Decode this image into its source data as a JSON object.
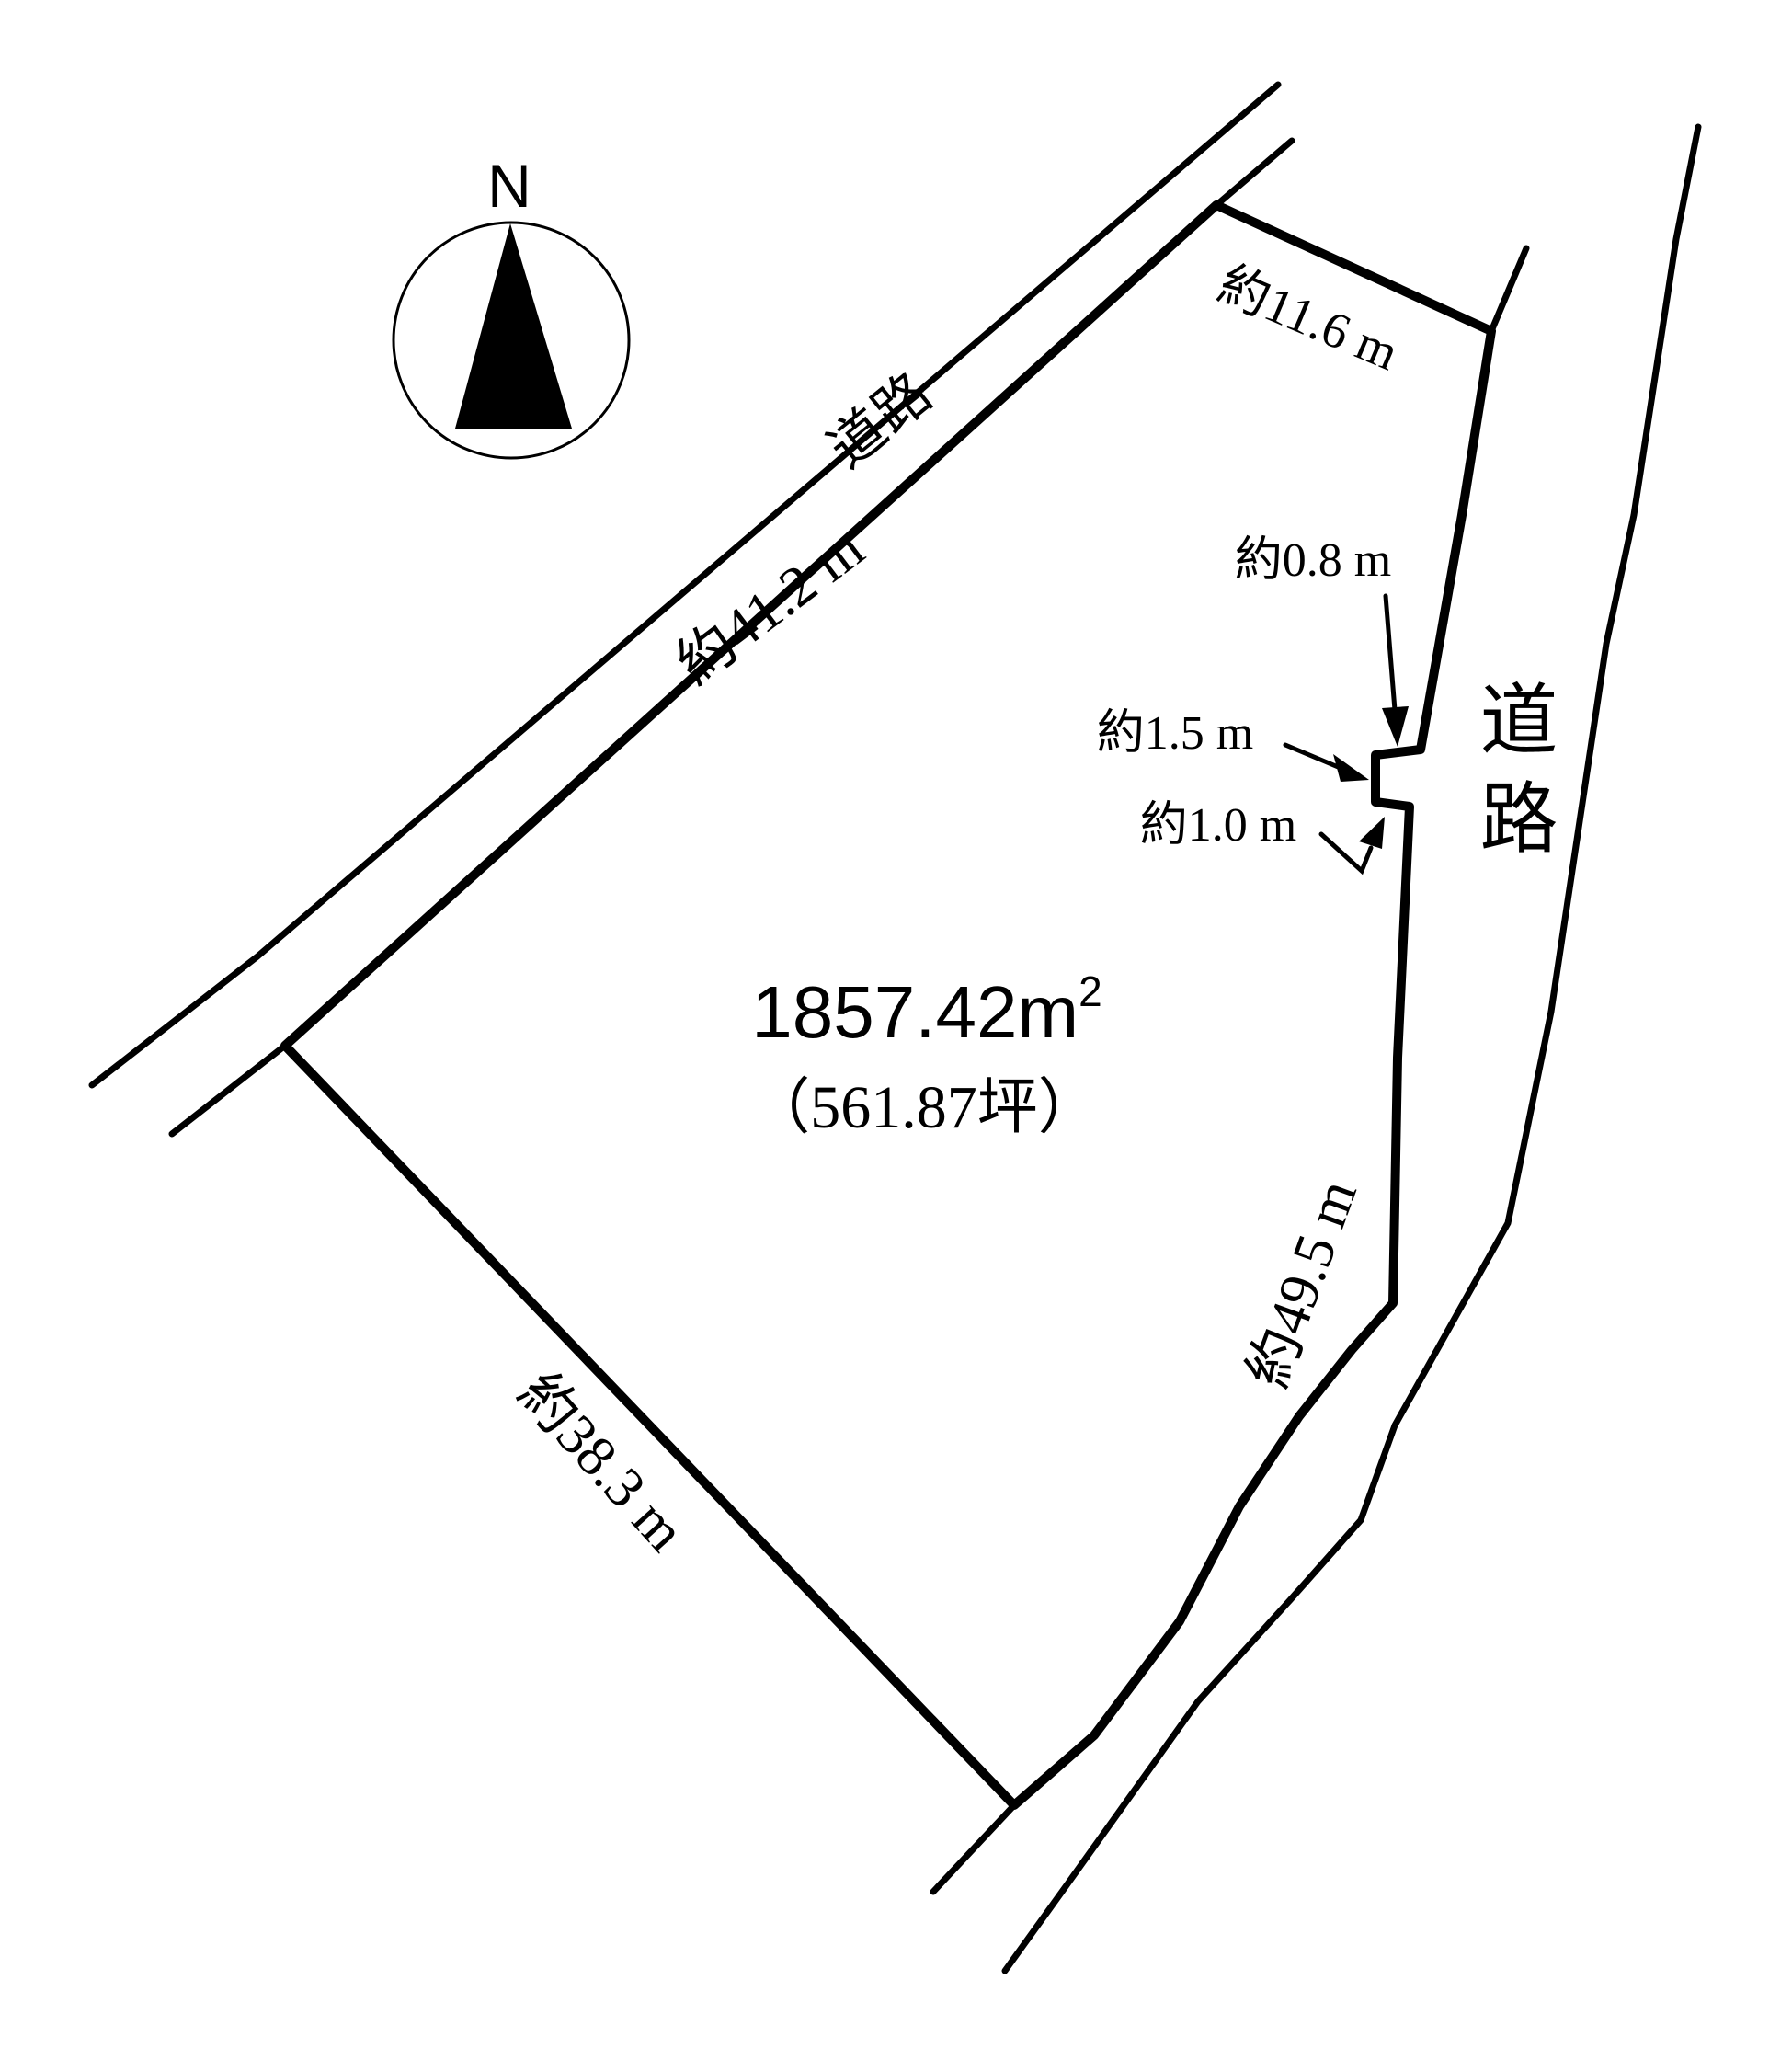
{
  "compass": {
    "north": "N"
  },
  "roads": {
    "top_road_label": "道路",
    "right_road_label": "道路"
  },
  "area": {
    "value": "1857.42",
    "unit": "m",
    "superscript": "2",
    "tsubo": "（561.87坪）"
  },
  "dimensions": {
    "road_side_top_left": "約41.2 m",
    "north_edge": "約11.6 m",
    "notch_offset": "約0.8 m",
    "notch_width": "約1.5 m",
    "notch_depth": "約1.0 m",
    "south_west_edge": "約38.3 m",
    "east_edge": "約49.5 m"
  }
}
